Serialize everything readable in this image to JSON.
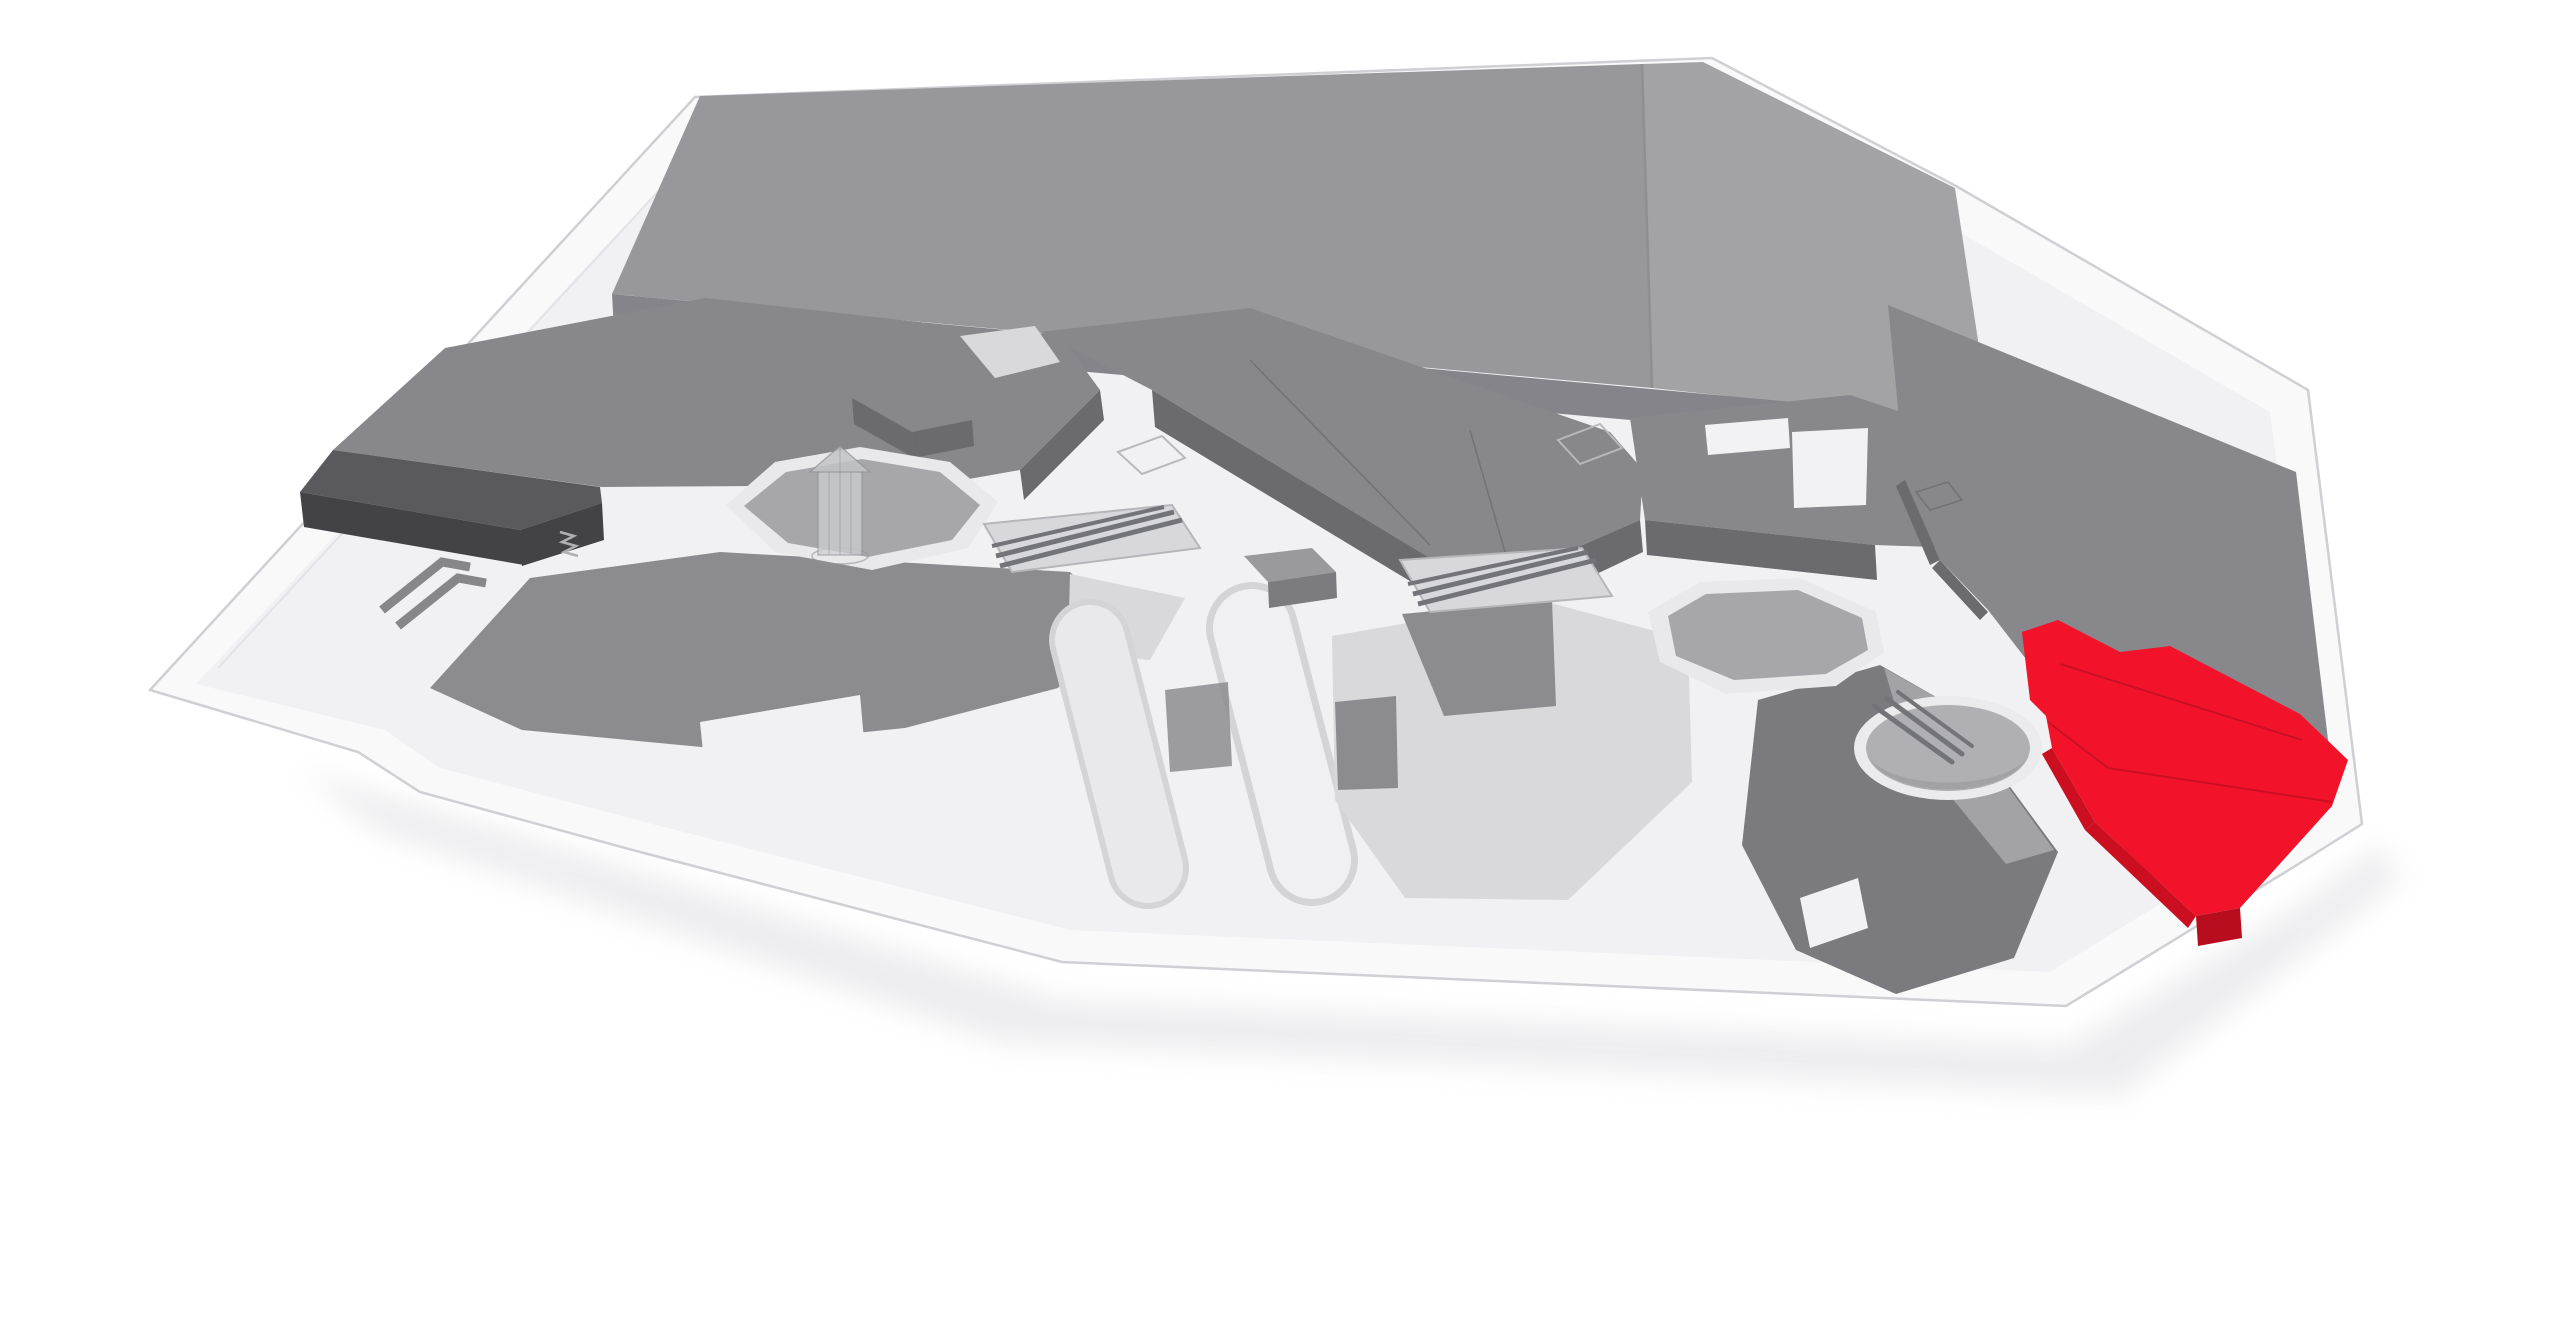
{
  "scene": {
    "type": "3d-mall-floor-map",
    "projection": "elevated oblique perspective",
    "background": "#ffffff",
    "selected_unit": {
      "id": "selected-store",
      "state": "highlighted",
      "color": "#f2132b"
    },
    "features": [
      {
        "id": "selected-store",
        "desc": "highlighted store unit (red)"
      },
      {
        "id": "anchor-roof",
        "desc": "large anchor roof slab with seam"
      },
      {
        "id": "left-store-mass",
        "desc": "large store block with dark front extension"
      },
      {
        "id": "store-wedges",
        "desc": "extruded mid-gray store volumes along concourse"
      },
      {
        "id": "gazebo-court",
        "desc": "sunken octagonal court with glass gazebo elevator"
      },
      {
        "id": "open-court",
        "desc": "second sunken octagonal court"
      },
      {
        "id": "escalator-well",
        "desc": "circular escalator well"
      },
      {
        "id": "escalator-bank",
        "desc": "diagonal escalator banks",
        "count": 3
      },
      {
        "id": "kiosk",
        "desc": "freestanding kiosk box"
      },
      {
        "id": "entrance-arrow",
        "desc": "double chevron entrance direction marker"
      },
      {
        "id": "stairs-mark",
        "desc": "small zigzag stair marking"
      },
      {
        "id": "skylight-outline",
        "desc": "wireframe skylight outlines on floor",
        "count": 2
      }
    ],
    "colors": {
      "background": "#ffffff",
      "base_plate": "#f9f9fa",
      "base_edge": "#cfcfd4",
      "inner_edge": "#e3e3e7",
      "platform": "#f1f1f4",
      "shadow": "#d7d7dc",
      "roof_left": "#98989c",
      "roof_right": "#a3a3a6",
      "roof_side": "#84848a",
      "roof_seam": "#8e8e93",
      "block_top": "#88888c",
      "block_side": "#6a6a6f",
      "dark_top": "#5a5a5e",
      "dark_side": "#424247",
      "flat_gray": "#8c8c90",
      "flat_dark": "#7b7b7f",
      "flat_dark_lighter": "#a3a3a7",
      "flat_light": "#d9d9dc",
      "flat_lighter": "#e8e8eb",
      "court_rim": "#e9e9ec",
      "court_floor": "#a7a7ab",
      "pit_rim": "#ebebee",
      "pit_floor": "#b0b0b4",
      "pit_shade": "#97979b",
      "pill_outline": "#d4d4d8",
      "pill_mid": "#e9e9ec",
      "pill_top": "#f0f0f3",
      "esc_bed": "#d8d8dc",
      "esc_bar": "#73737a",
      "esc_edge": "#b5b5ba",
      "glass_body": "#cfd0d4",
      "glass_roof": "#c3c4c8",
      "glass_line": "#94949a",
      "kiosk_top": "#9a9a9e",
      "kiosk_side": "#7c7c80",
      "white_cut": "#f2f2f4",
      "red_top": "#f2132b",
      "red_side": "#cc0e21",
      "red_dark": "#b80d1e",
      "red_line": "#c00f22",
      "arrow": "#87878b",
      "mark": "#b0b0b4",
      "wireframe": "#b9b9bd"
    }
  }
}
